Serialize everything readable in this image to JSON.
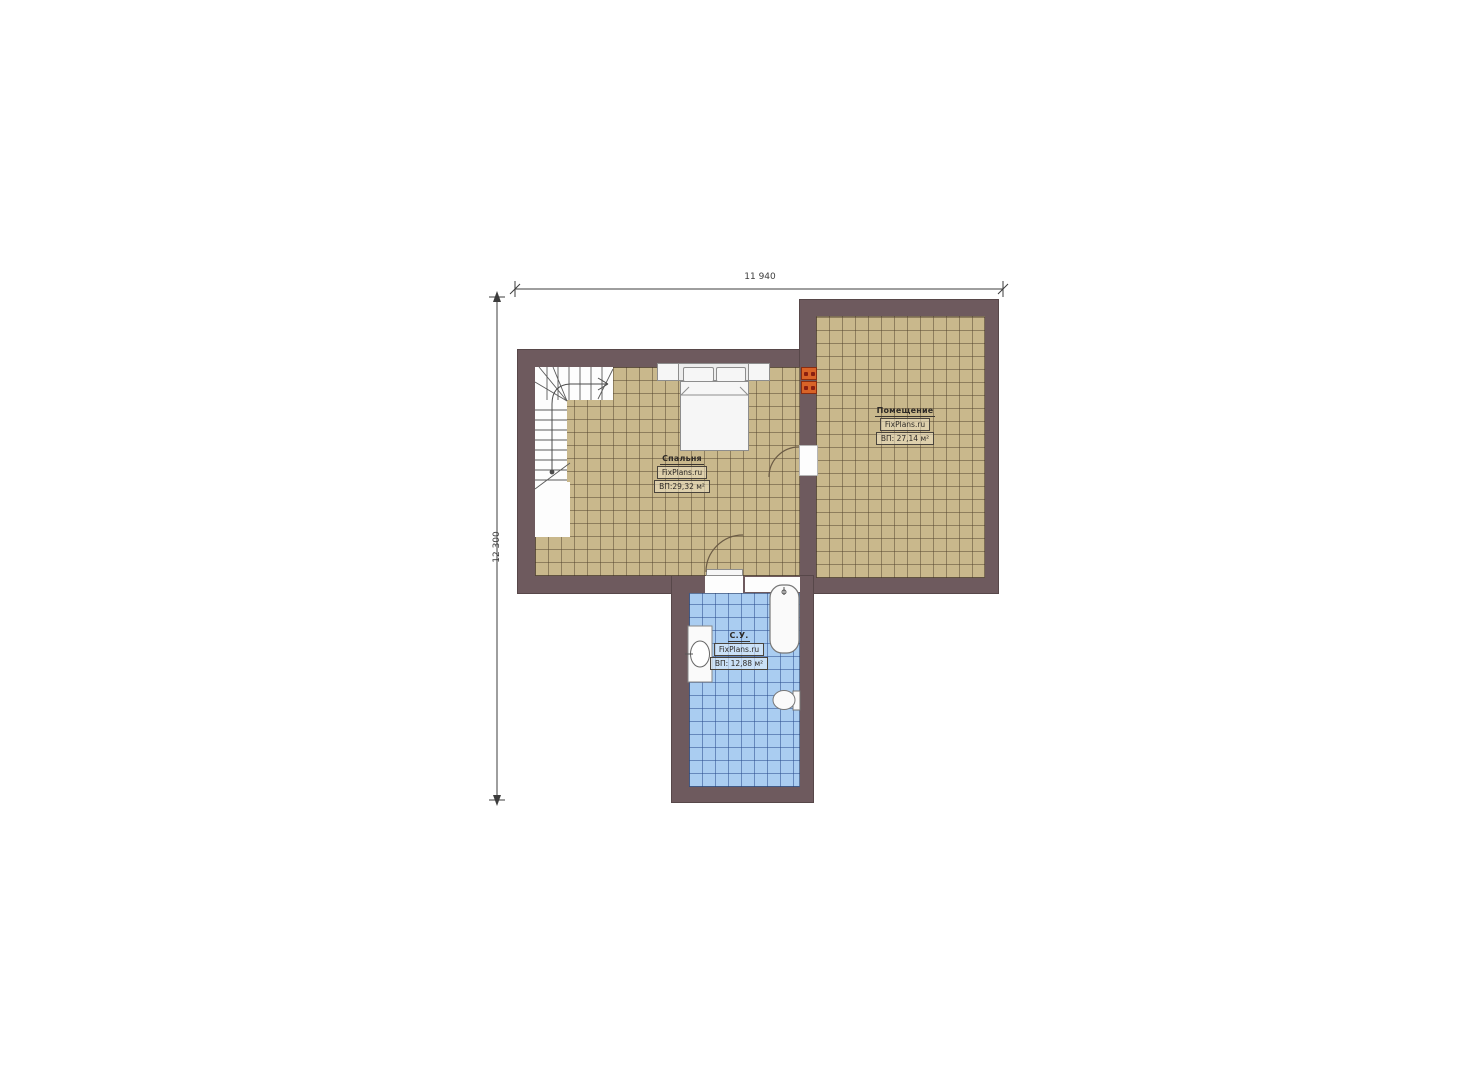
{
  "plan": {
    "type": "floor-plan",
    "dimensions": {
      "width_label": "11 940",
      "height_label": "12 300"
    },
    "rooms": {
      "bedroom": {
        "name": "Спальня",
        "site": "FixPlans.ru",
        "area": "ВП:29,32 м²"
      },
      "hall": {
        "name": "Помещение",
        "site": "FixPlans.ru",
        "area": "ВП: 27,14 м²"
      },
      "bathroom": {
        "name": "С.У.",
        "site": "FixPlans.ru",
        "area": "ВП: 12,88 м²"
      }
    },
    "colors": {
      "wall": "#6e5a5e",
      "bedroom_floor_tile": "#c9b88c",
      "bathroom_floor_tile": "#aacdf1",
      "heater_unit": "#d96327",
      "fixture": "#f6f6f6"
    },
    "fixtures": [
      "staircase",
      "double-bed",
      "nightstands",
      "heater-units",
      "bathtub",
      "washbasin",
      "toilet"
    ]
  }
}
